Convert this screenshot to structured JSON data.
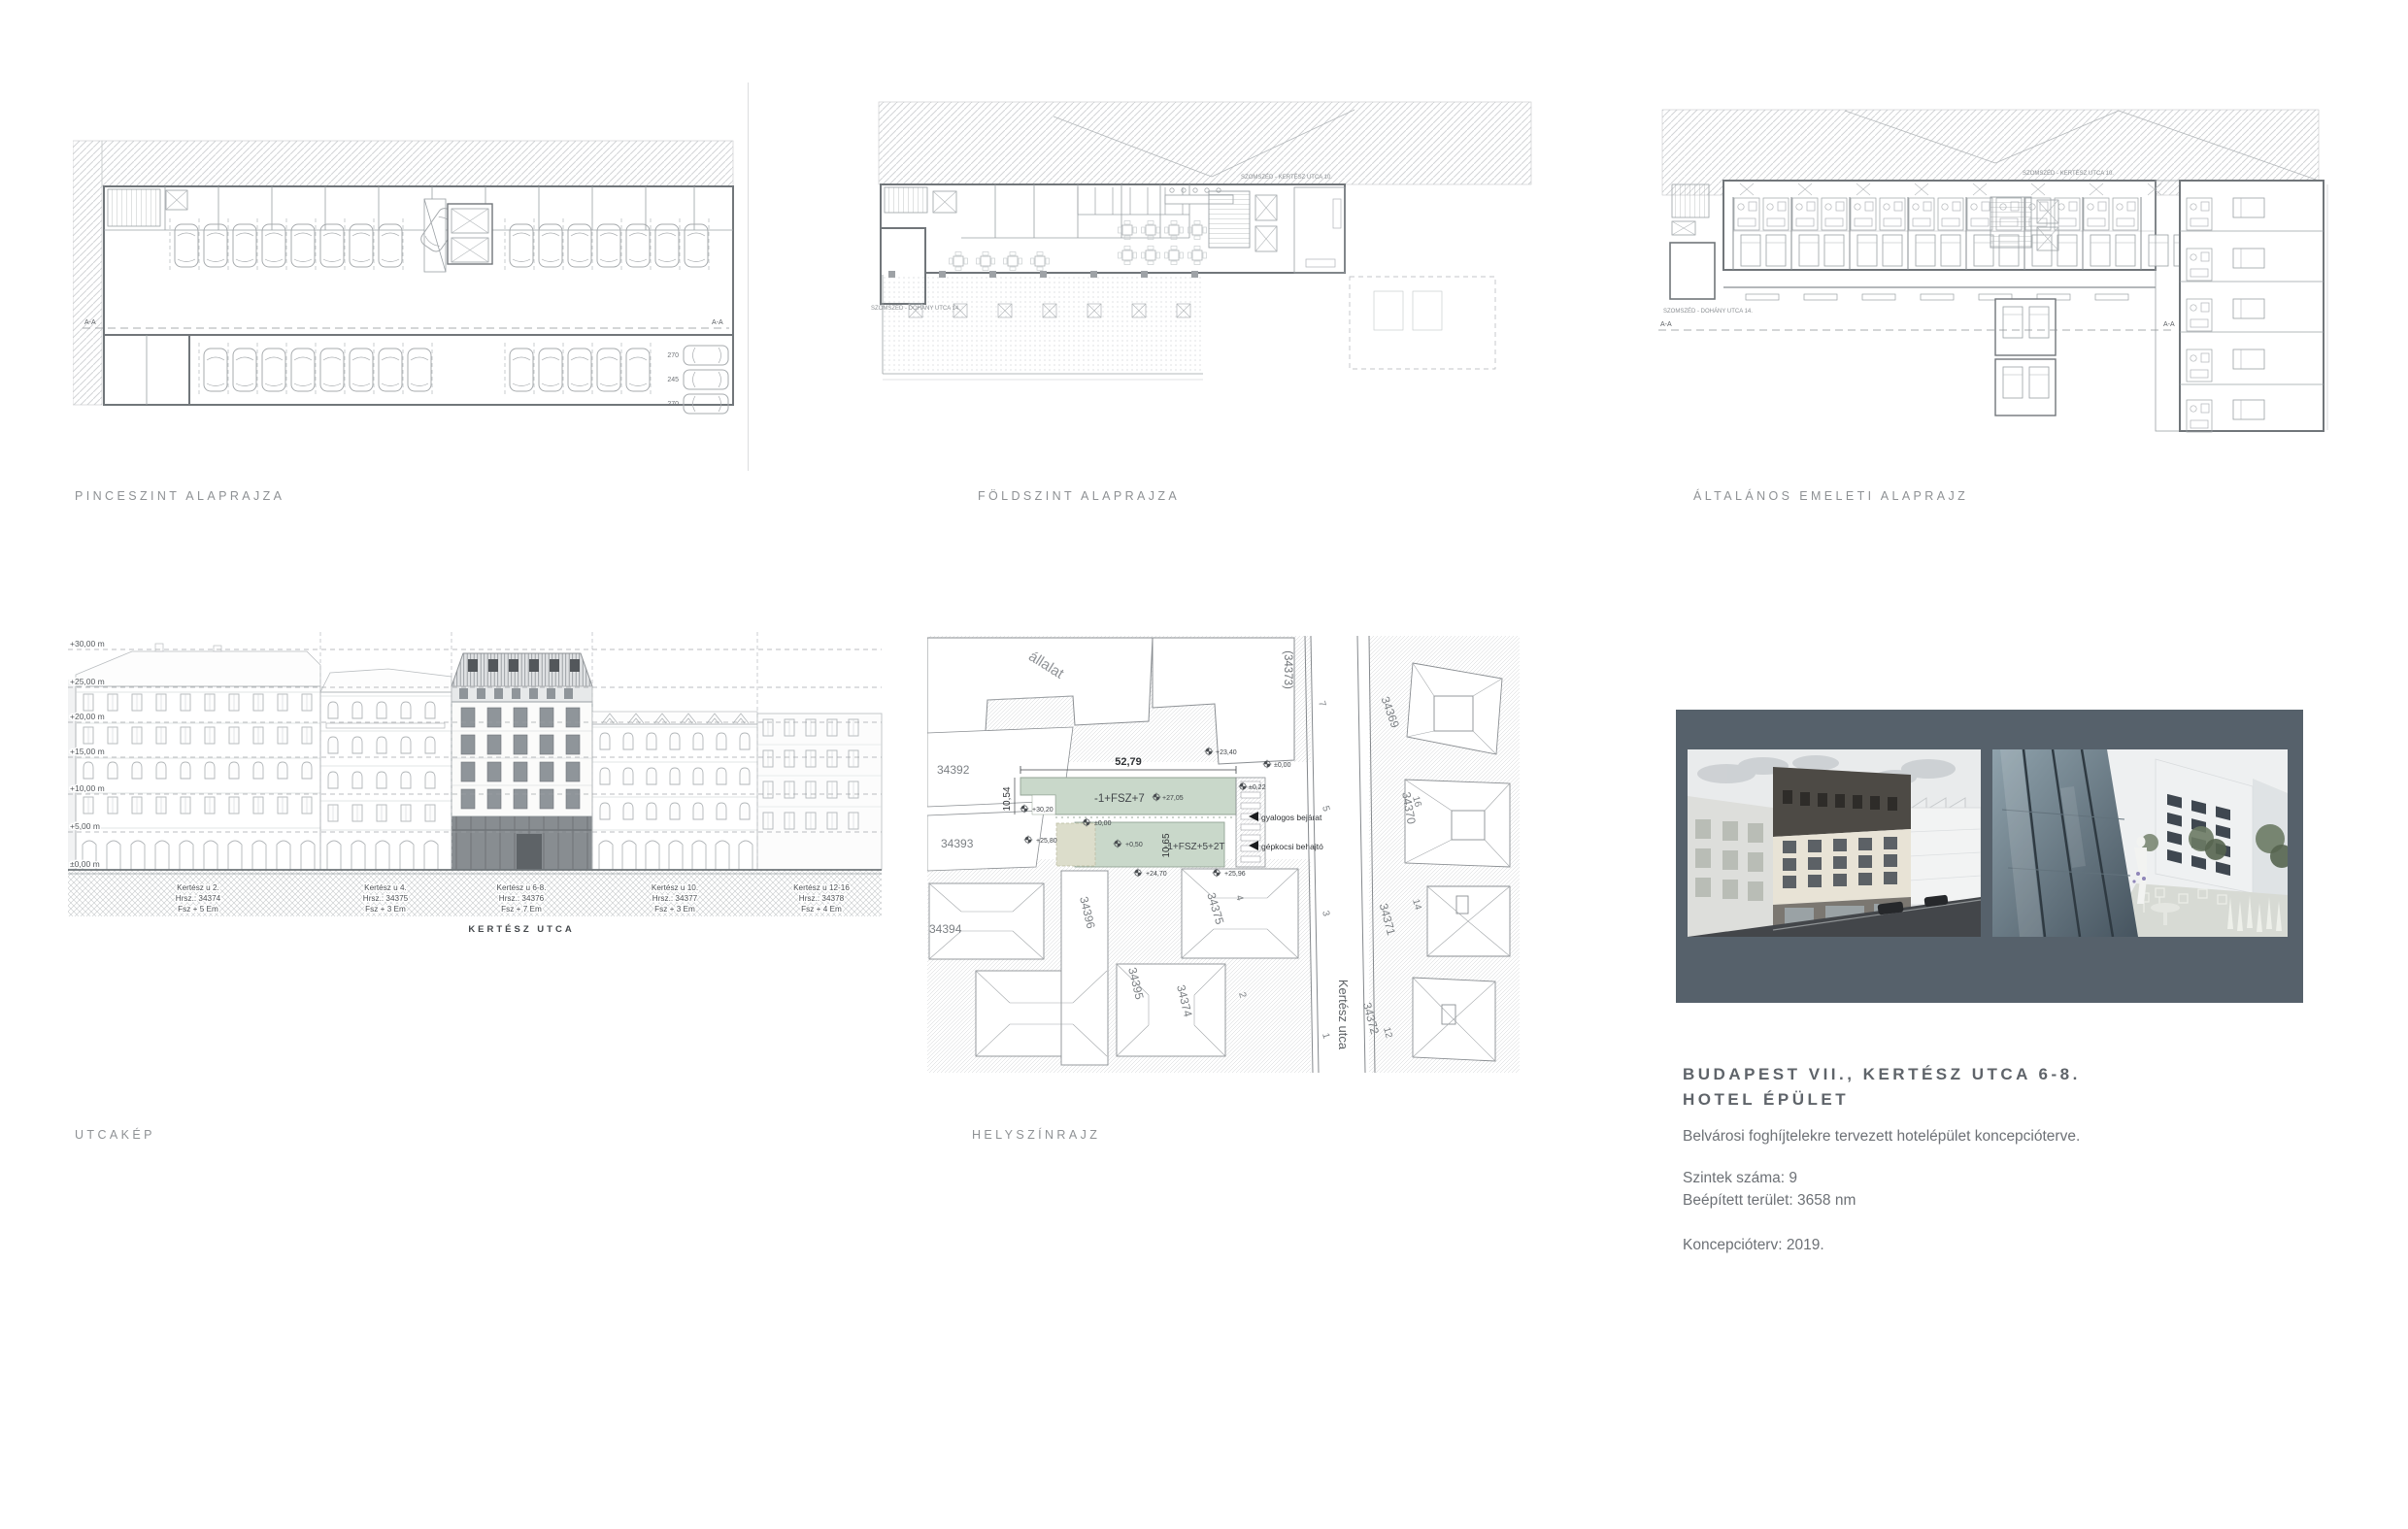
{
  "plan_labels": {
    "basement": "PINCESZINT ALAPRAJZA",
    "ground": "FÖLDSZINT ALAPRAJZA",
    "upper": "ÁLTALÁNOS EMELETI ALAPRAJZ"
  },
  "plans": {
    "neighbor_top": "SZOMSZÉD - KERTÉSZ UTCA 10.",
    "neighbor_left": "SZOMSZÉD - DOHÁNY UTCA 14.",
    "section_mark": "A-A",
    "stall_a": "270",
    "stall_b": "245",
    "stall_c": "270"
  },
  "elevation": {
    "label": "UTCAKÉP",
    "levels": [
      "+30,00 m",
      "+25,00 m",
      "+20,00 m",
      "+15,00 m",
      "+10,00 m",
      "+5,00 m",
      "±0,00 m"
    ],
    "street": "KERTÉSZ UTCA",
    "buildings": [
      {
        "name": "Kertész u 2.",
        "hrsz": "Hrsz.: 34374",
        "floors": "Fsz + 5 Em"
      },
      {
        "name": "Kertész u 4.",
        "hrsz": "Hrsz.: 34375",
        "floors": "Fsz + 3 Em"
      },
      {
        "name": "Kertész u 6-8.",
        "hrsz": "Hrsz.: 34376",
        "floors": "Fsz + 7 Em"
      },
      {
        "name": "Kertész u 10.",
        "hrsz": "Hrsz.: 34377",
        "floors": "Fsz + 3 Em"
      },
      {
        "name": "Kertész u 12-16",
        "hrsz": "Hrsz.: 34378",
        "floors": "Fsz + 4 Em"
      }
    ]
  },
  "siteplan": {
    "label": "HELYSZÍNRAJZ",
    "street_name": "Kertész utca",
    "street_parcel": "(34373)",
    "partial_text": "állalat",
    "building_top": "-1+FSZ+7",
    "building_bottom": "-1+FSZ+5+2T",
    "dim_width": "52,79",
    "dim_left": "10,54",
    "dim_mid": "10,65",
    "entry_pedestrian": "gyalogos bejárat",
    "entry_vehicle": "gépkocsi behajtó",
    "levels": {
      "l1": "+23,40",
      "l2": "±0,00",
      "l3": "+27,05",
      "l4": "+30,20",
      "l5": "±0,22",
      "l6": "+25,80",
      "l7": "±0,00",
      "l8": "+0,50",
      "l9": "+24,70",
      "l10": "+25,96"
    },
    "parcels": {
      "p34392": "34392",
      "p34393": "34393",
      "p34394": "34394",
      "p34395": "34395",
      "p34396": "34396",
      "p34374": "34374",
      "p34375": "34375",
      "p34369": "34369",
      "p34370": "34370",
      "p34371": "34371",
      "p34372": "34372"
    },
    "house_numbers": {
      "n7": "7",
      "n5": "5",
      "n4": "4",
      "n3": "3",
      "n2": "2",
      "n1": "1",
      "n16": "16",
      "n14": "14",
      "n12": "12"
    }
  },
  "project": {
    "title_line1": "BUDAPEST VII., KERTÉSZ UTCA 6-8.",
    "title_line2": "HOTEL ÉPÜLET",
    "description": "Belvárosi foghíjtelekre tervezett hotelépület koncepcióterve.",
    "stat1": "Szintek száma: 9",
    "stat2": "Beépített terület: 3658 nm",
    "year": "Koncepcióterv: 2019."
  },
  "colors": {
    "panel": "#56616b",
    "site_green": "#c9d8ca",
    "label_gray": "#8e9194"
  }
}
